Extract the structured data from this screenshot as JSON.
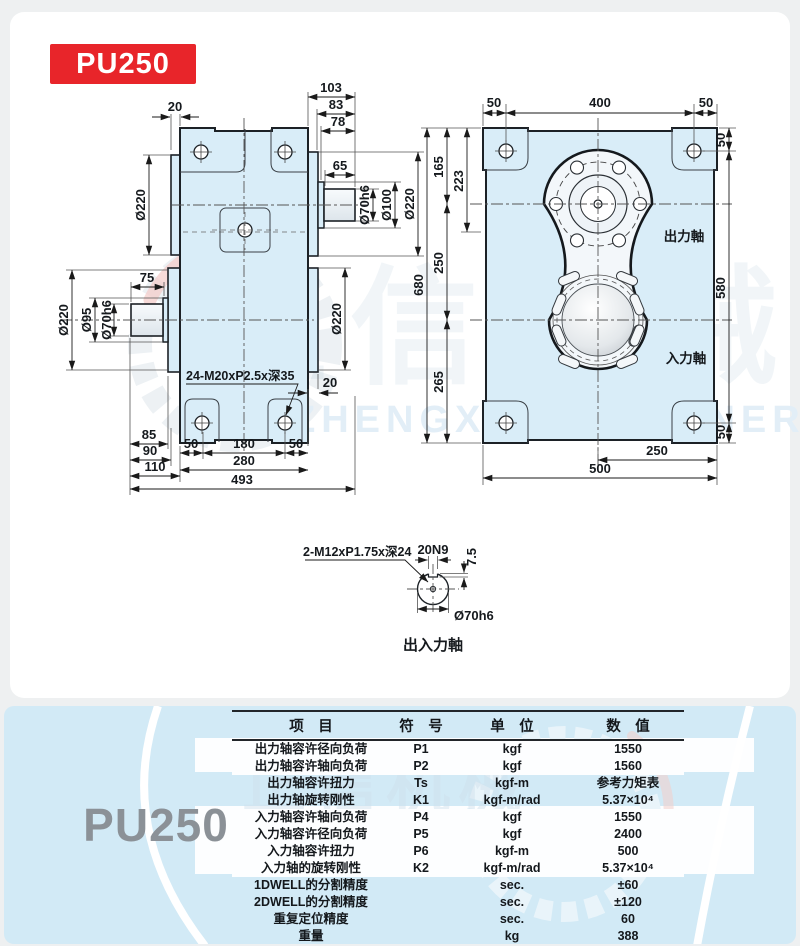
{
  "badge": {
    "label": "PU250"
  },
  "watermark": {
    "cn": "正信机械",
    "en": "ZHENGXIN MACHINERY"
  },
  "front_view": {
    "dims": {
      "top_20": "20",
      "top_103": "103",
      "top_83": "83",
      "top_78": "78",
      "shaft_65": "65",
      "right_d70h6": "Ø70h6",
      "right_d100": "Ø100",
      "right_d220": "Ø220",
      "left_top_d220": "Ø220",
      "left_75": "75",
      "left_d220": "Ø220",
      "left_d95": "Ø95",
      "left_d70h6": "Ø70h6",
      "mid_right_d220": "Ø220",
      "tap_note": "24-M20xP2.5x深35",
      "right_20": "20",
      "bot_85": "85",
      "bot_90": "90",
      "bot_110": "110",
      "bot_50a": "50",
      "bot_180": "180",
      "bot_50b": "50",
      "bot_280": "280",
      "bot_493": "493"
    }
  },
  "top_view": {
    "dims": {
      "top_50a": "50",
      "top_400": "400",
      "top_50b": "50",
      "left_165": "165",
      "left_223": "223",
      "left_250": "250",
      "left_265": "265",
      "left_680": "680",
      "right_50t": "50",
      "right_580": "580",
      "right_50b": "50",
      "bot_250": "250",
      "bot_500": "500"
    },
    "labels": {
      "output_shaft": "出力軸",
      "input_shaft": "入力軸"
    }
  },
  "shaft_detail": {
    "tap_note": "2-M12xP1.75x深24",
    "key_width": "20N9",
    "key_depth": "7.5",
    "diameter": "Ø70h6",
    "caption": "出入力軸"
  },
  "spec_panel": {
    "model": "PU250",
    "table": {
      "headers": [
        "项　目",
        "符　号",
        "单　位",
        "数　值"
      ],
      "rows": [
        {
          "item": "出力轴容许径向负荷",
          "symbol": "P1",
          "unit": "kgf",
          "value": "1550"
        },
        {
          "item": "出力轴容许轴向负荷",
          "symbol": "P2",
          "unit": "kgf",
          "value": "1560"
        },
        {
          "item": "出力轴容许扭力",
          "symbol": "Ts",
          "unit": "kgf-m",
          "value": "参考力矩表"
        },
        {
          "item": "出力轴旋转刚性",
          "symbol": "K1",
          "unit": "kgf-m/rad",
          "value": "5.37×10⁴"
        },
        {
          "item": "入力轴容许轴向负荷",
          "symbol": "P4",
          "unit": "kgf",
          "value": "1550"
        },
        {
          "item": "入力轴容许径向负荷",
          "symbol": "P5",
          "unit": "kgf",
          "value": "2400"
        },
        {
          "item": "入力轴容许扭力",
          "symbol": "P6",
          "unit": "kgf-m",
          "value": "500"
        },
        {
          "item": "入力轴的旋转刚性",
          "symbol": "K2",
          "unit": "kgf-m/rad",
          "value": "5.37×10⁴"
        },
        {
          "item": "1DWELL的分割精度",
          "symbol": "",
          "unit": "sec.",
          "value": "±60"
        },
        {
          "item": "2DWELL的分割精度",
          "symbol": "",
          "unit": "sec.",
          "value": "±120"
        },
        {
          "item": "重复定位精度",
          "symbol": "",
          "unit": "sec.",
          "value": "60"
        },
        {
          "item": "重量",
          "symbol": "",
          "unit": "kg",
          "value": "388"
        }
      ]
    }
  },
  "colors": {
    "badge_red": "#e8252a",
    "card_blue": "#d2eaf6",
    "body_fill": "#d9edf8",
    "line": "#1c2126",
    "model_gray": "#8b9197"
  }
}
